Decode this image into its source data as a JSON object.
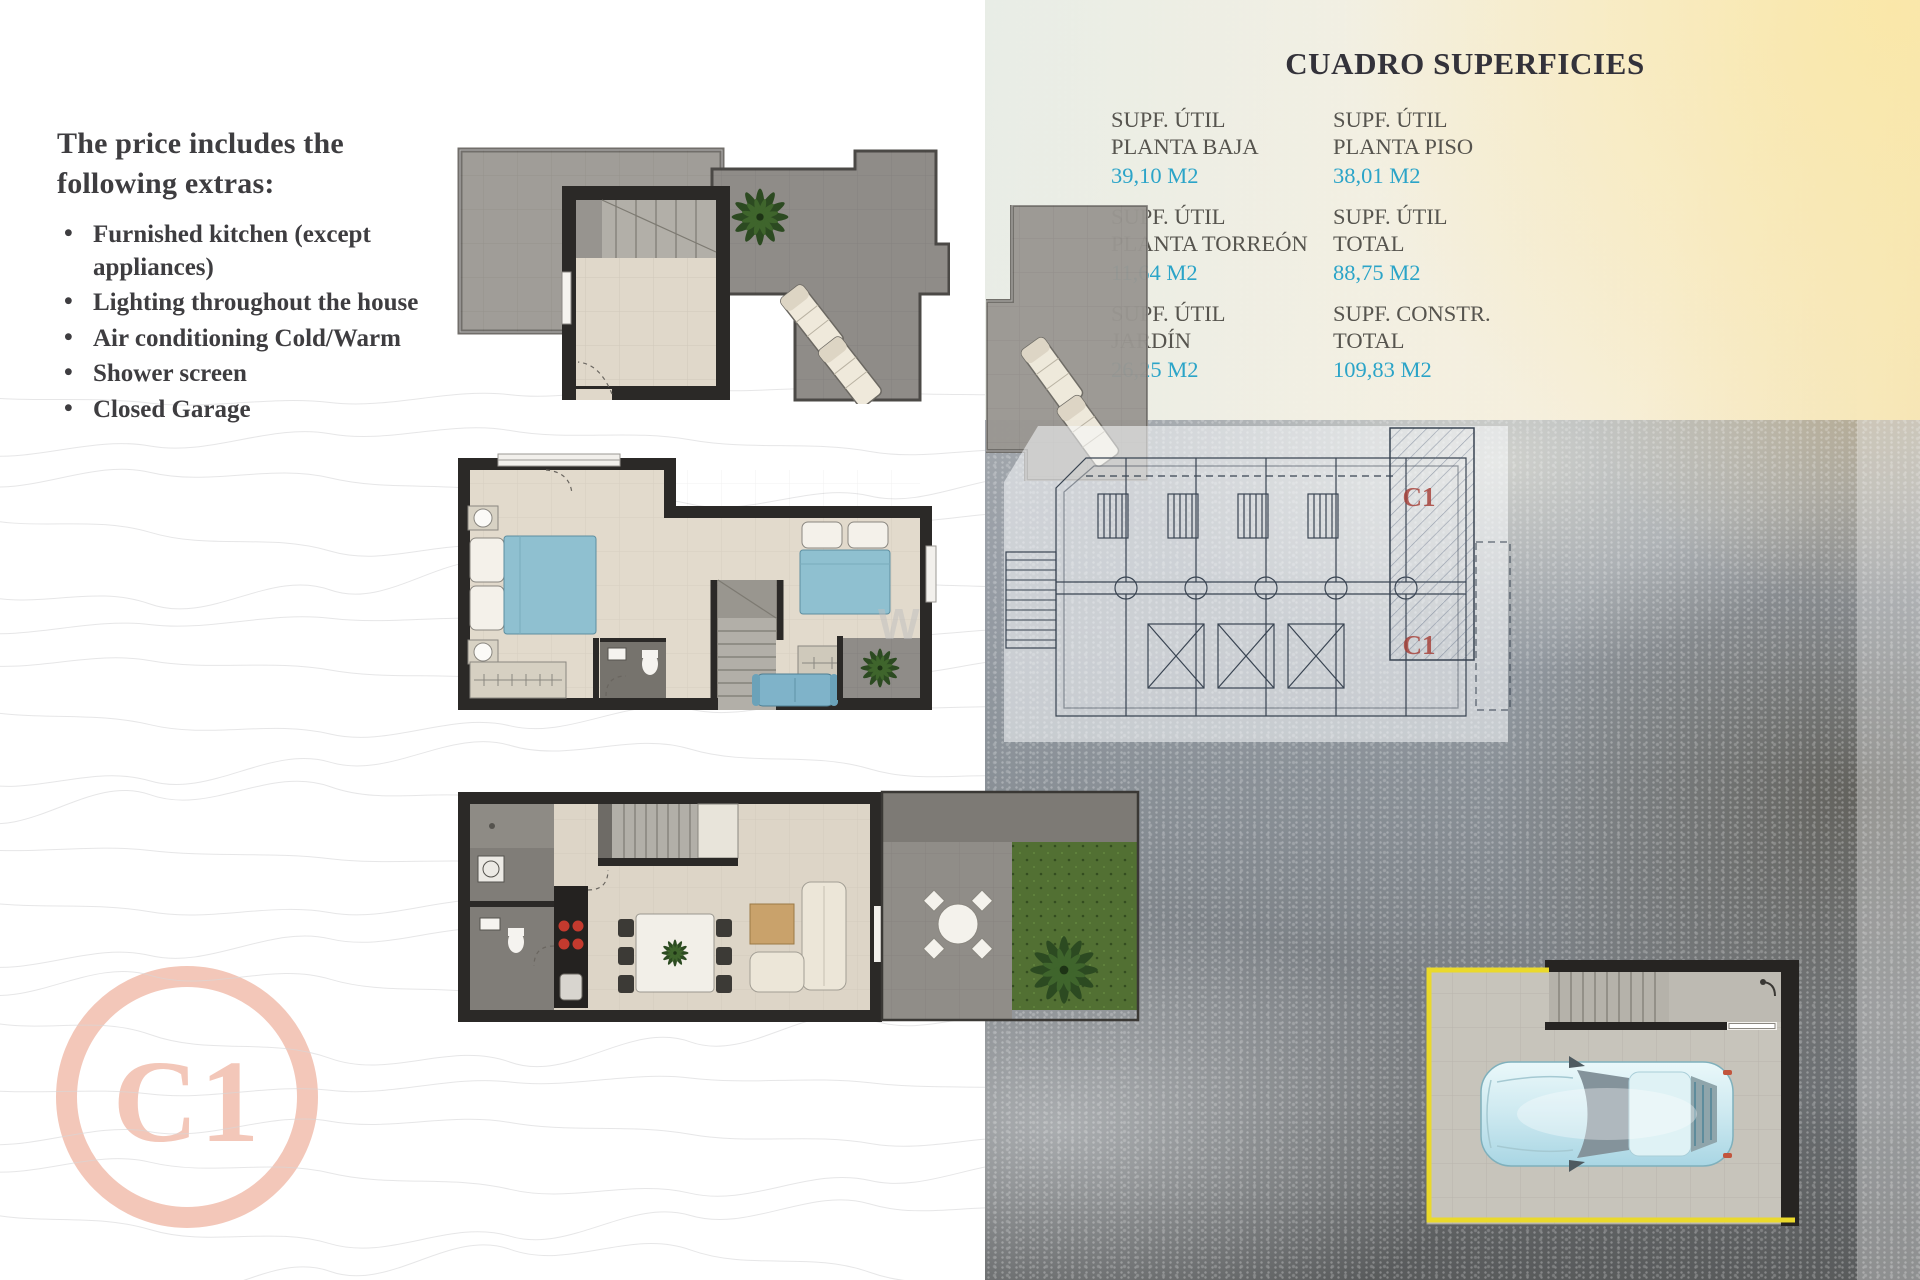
{
  "extras": {
    "title": "The price includes the following extras:",
    "items": [
      "Furnished kitchen (except appliances)",
      "Lighting throughout the house",
      "Air conditioning Cold/Warm",
      "Shower screen",
      "Closed Garage"
    ]
  },
  "surfaces": {
    "title": "CUADRO SUPERFICIES",
    "cells": [
      {
        "line1": "SUPF. ÚTIL",
        "line2": "PLANTA BAJA",
        "value": "39,10 M2"
      },
      {
        "line1": "SUPF. ÚTIL",
        "line2": "PLANTA PISO",
        "value": "38,01 M2"
      },
      {
        "line1": "SUPF. ÚTIL",
        "line2": "PLANTA TORREÓN",
        "value": "11,64 M2"
      },
      {
        "line1": "SUPF. ÚTIL",
        "line2": "TOTAL",
        "value": "88,75 M2"
      },
      {
        "line1": "SUPF. ÚTIL",
        "line2": "JARDÍN",
        "value": "26,25 M2"
      },
      {
        "line1": "SUPF. CONSTR.",
        "line2": "TOTAL",
        "value": "109,83 M2"
      }
    ]
  },
  "unit": {
    "badge": "C1"
  },
  "site_plan": {
    "unit_labels": [
      "C1",
      "C1"
    ]
  },
  "watermark": "W",
  "colors": {
    "accent_cyan": "#2ba4c8",
    "logo_salmon": "#f3c7b9",
    "garage_yellow": "#ead92b",
    "site_label_red": "#a63f37",
    "wall_black": "#2b2927",
    "floor_beige": "#e2dacc",
    "terrace_grey": "#8f8c88",
    "grass_green": "#527033",
    "bed_blue": "#8fc0d0"
  }
}
